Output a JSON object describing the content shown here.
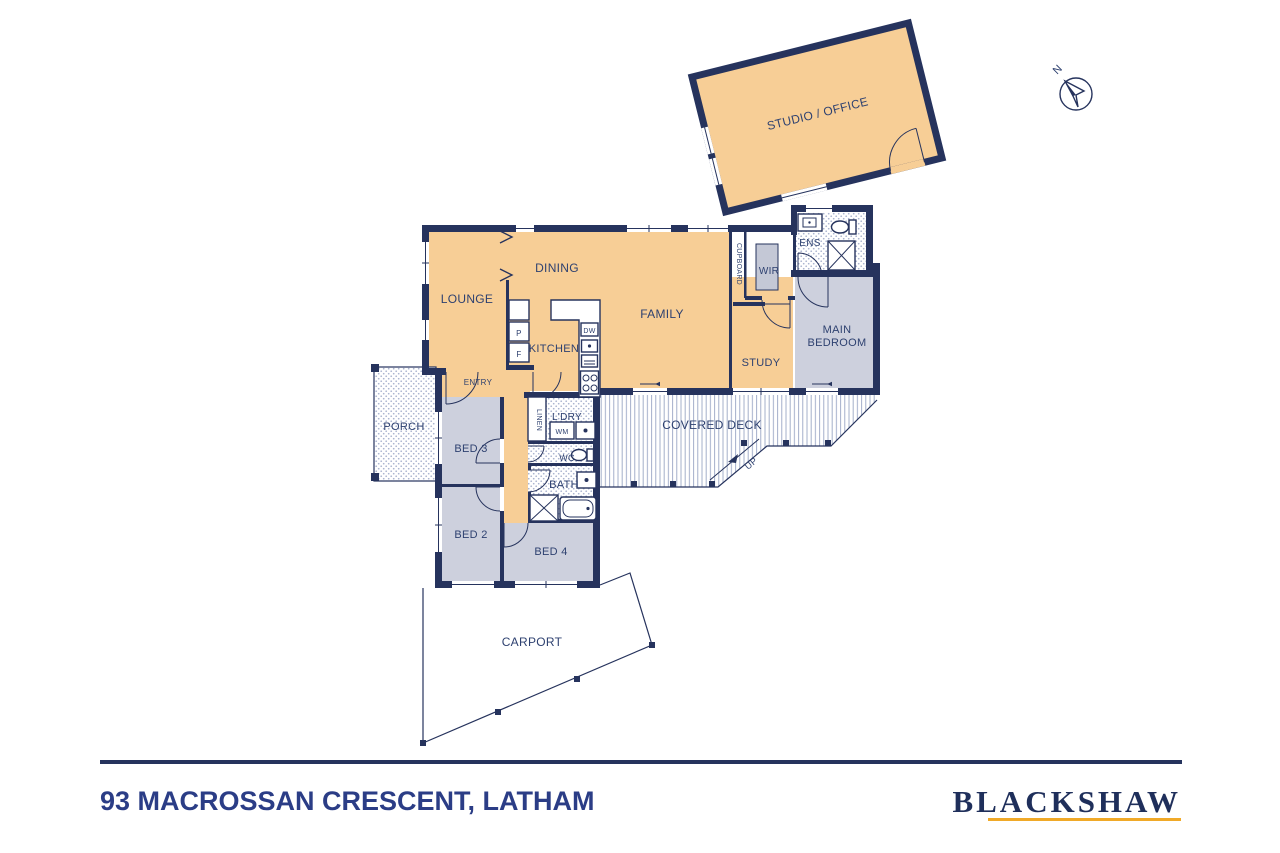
{
  "address": "93 MACROSSAN CRESCENT, LATHAM",
  "brand": {
    "name": "BLACKSHAW"
  },
  "compass": {
    "label": "N"
  },
  "rooms": {
    "studio": "STUDIO / OFFICE",
    "lounge": "LOUNGE",
    "dining": "DINING",
    "kitchen": "KITCHEN",
    "family": "FAMILY",
    "cupboard": "CUPBOARD",
    "wir": "WIR",
    "ens": "ENS",
    "study": "STUDY",
    "main_bedroom_line1": "MAIN",
    "main_bedroom_line2": "BEDROOM",
    "entry": "ENTRY",
    "porch": "PORCH",
    "bed3": "BED 3",
    "bed2": "BED 2",
    "bed4": "BED 4",
    "linen": "LINEN",
    "laundry": "L'DRY",
    "wc": "WC",
    "bath": "BATH",
    "covered_deck": "COVERED DECK",
    "up": "UP",
    "carport": "CARPORT"
  },
  "fixtures": {
    "pantry": "P",
    "fridge": "F",
    "dishwasher": "DW",
    "washing_machine": "WM"
  },
  "colors": {
    "wall_navy": "#26335D",
    "label_navy": "#2E4170",
    "living_tan": "#F7CE96",
    "bedroom_grey": "#CDD0DD",
    "brand_navy": "#1F2F5B",
    "brand_gold": "#F0A928",
    "address_blue": "#2B3D86"
  }
}
